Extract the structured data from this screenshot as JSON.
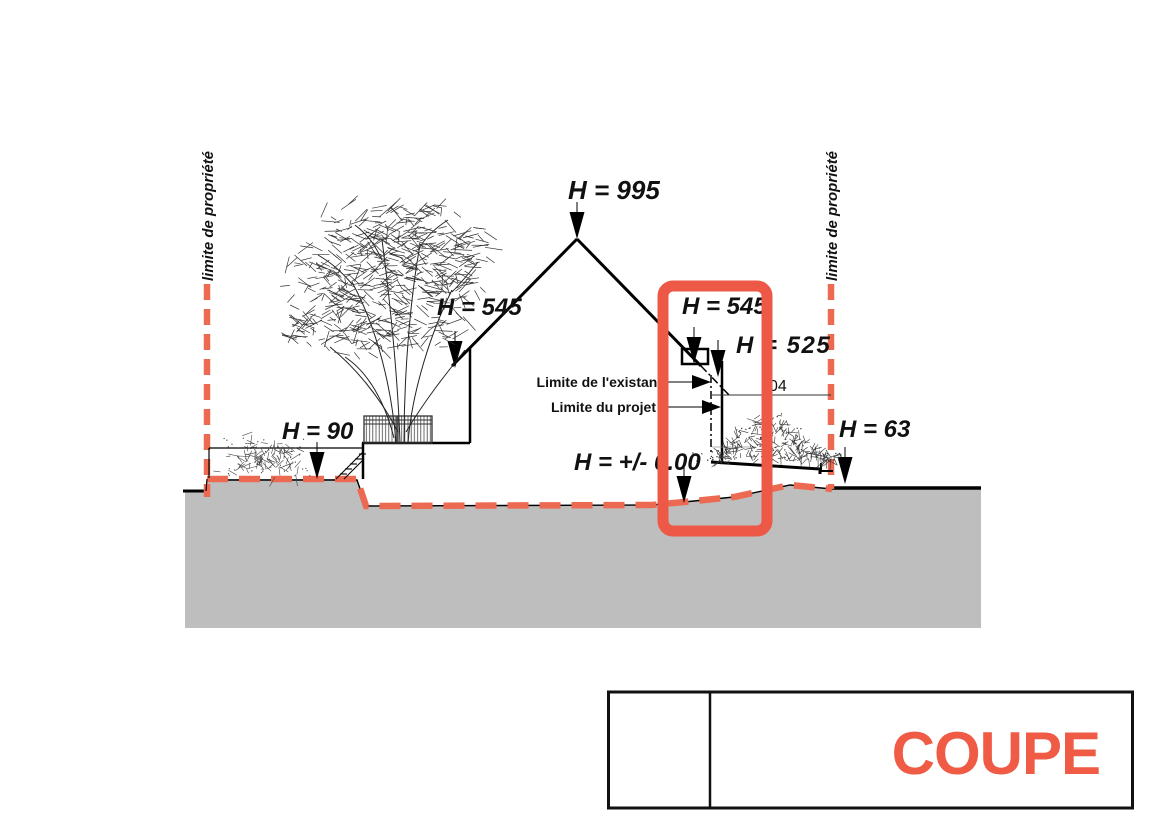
{
  "drawing": {
    "property_limit_left": "limite de propriété",
    "property_limit_right": "limite de propriété",
    "heights": {
      "ridge": "H = 995",
      "eave_left": "H = 545",
      "parapet_right": "H = 545",
      "flat_roof": "H = 525",
      "terrace": "H = 90",
      "ground_right": "H = 63",
      "ground_zero": "H = +/- 0.00"
    },
    "limits": {
      "existing": "Limite de l'existant",
      "project": "Limite du projet"
    },
    "partial_dimension": "04"
  },
  "title_block": {
    "title": "COUPE"
  },
  "colors": {
    "accent_red": "#ee5847",
    "dash_orange": "#ed6a52",
    "title_orange": "#ef5b45",
    "ground_gray": "#bebebe"
  }
}
